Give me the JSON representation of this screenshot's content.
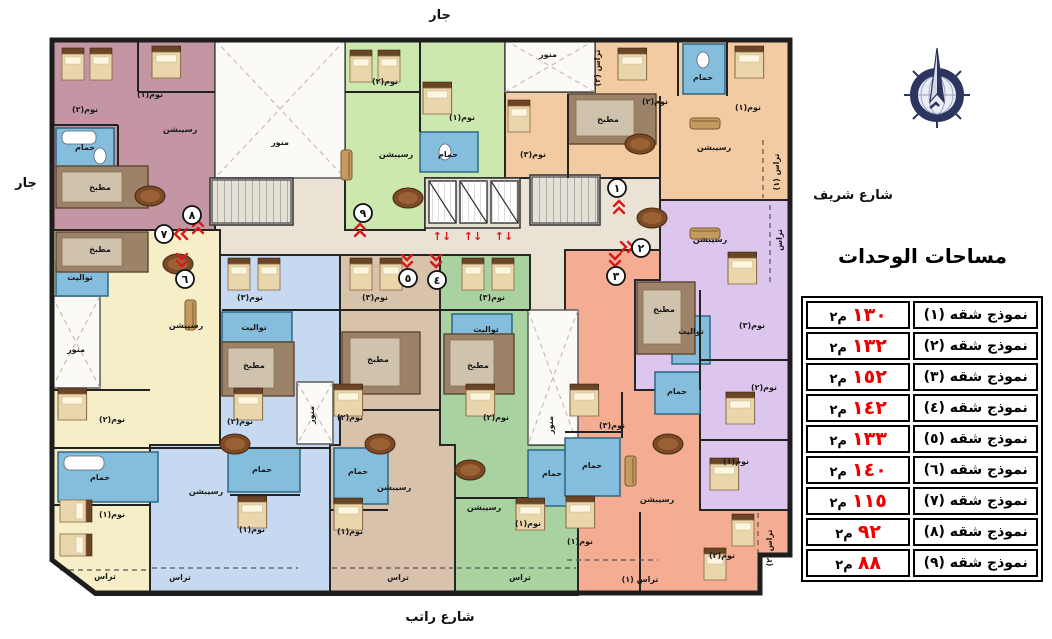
{
  "surroundings": {
    "top": "جار",
    "left": "جار",
    "right": "شارع شريف",
    "bottom": "شارع راتب"
  },
  "legend": {
    "title": "مساحات الوحدات",
    "unit_suffix": "م٢",
    "area_color": "#ee0000",
    "rows": [
      {
        "model": "نموذج شقه (١)",
        "area": "١٣٠"
      },
      {
        "model": "نموذج شقه (٢)",
        "area": "١٣٢"
      },
      {
        "model": "نموذج شقه (٣)",
        "area": "١٥٢"
      },
      {
        "model": "نموذج شقه (٤)",
        "area": "١٤٢"
      },
      {
        "model": "نموذج شقه (٥)",
        "area": "١٣٣"
      },
      {
        "model": "نموذج شقه (٦)",
        "area": "١٤٠"
      },
      {
        "model": "نموذج شقه (٧)",
        "area": "١١٥"
      },
      {
        "model": "نموذج شقه (٨)",
        "area": "٩٢"
      },
      {
        "model": "نموذج شقه (٩)",
        "area": "٨٨"
      }
    ]
  },
  "compass": {
    "name": "compass-rose",
    "ring_color": "#2b3560",
    "face_color": "#e9edf5"
  },
  "plan": {
    "corridor_color": "#eae2d4",
    "wall_color": "#1d1d1d",
    "arrow_color": "#d81a1a",
    "units": [
      {
        "id": 1,
        "number": "١",
        "color": "#f2cba2"
      },
      {
        "id": 2,
        "number": "٢",
        "color": "#ddc6ee"
      },
      {
        "id": 3,
        "number": "٣",
        "color": "#f4ad92"
      },
      {
        "id": 4,
        "number": "٤",
        "color": "#a9d2a0"
      },
      {
        "id": 5,
        "number": "٥",
        "color": "#d9c2ac"
      },
      {
        "id": 6,
        "number": "٦",
        "color": "#c6d9f1"
      },
      {
        "id": 7,
        "number": "٧",
        "color": "#f5eec6"
      },
      {
        "id": 8,
        "number": "٨",
        "color": "#c495a3"
      },
      {
        "id": 9,
        "number": "٩",
        "color": "#cce8ae"
      }
    ],
    "room_labels": [
      {
        "t": "نوم(٢)",
        "x": 85,
        "y": 112
      },
      {
        "t": "نوم(١)",
        "x": 150,
        "y": 97
      },
      {
        "t": "رسيبشن",
        "x": 180,
        "y": 132
      },
      {
        "t": "حمام",
        "x": 85,
        "y": 150
      },
      {
        "t": "مطبخ",
        "x": 100,
        "y": 190
      },
      {
        "t": "منور",
        "x": 280,
        "y": 145
      },
      {
        "t": "نوم(٢)",
        "x": 385,
        "y": 84
      },
      {
        "t": "نوم(١)",
        "x": 462,
        "y": 120
      },
      {
        "t": "حمام",
        "x": 448,
        "y": 157
      },
      {
        "t": "رسيبشن",
        "x": 396,
        "y": 157
      },
      {
        "t": "منور",
        "x": 548,
        "y": 57
      },
      {
        "t": "تراس (٢)",
        "x": 600,
        "y": 68,
        "r": -90
      },
      {
        "t": "نوم(٢)",
        "x": 655,
        "y": 104
      },
      {
        "t": "حمام",
        "x": 703,
        "y": 80
      },
      {
        "t": "نوم(١)",
        "x": 748,
        "y": 110
      },
      {
        "t": "نوم(٣)",
        "x": 533,
        "y": 157
      },
      {
        "t": "مطبخ",
        "x": 608,
        "y": 122
      },
      {
        "t": "رسيبشن",
        "x": 714,
        "y": 150
      },
      {
        "t": "تراس (١)",
        "x": 779,
        "y": 172,
        "r": -90
      },
      {
        "t": "رسيبشن",
        "x": 710,
        "y": 242
      },
      {
        "t": "تراس",
        "x": 782,
        "y": 240,
        "r": -90
      },
      {
        "t": "مطبخ",
        "x": 664,
        "y": 312
      },
      {
        "t": "تواليت",
        "x": 691,
        "y": 334
      },
      {
        "t": "نوم(٣)",
        "x": 752,
        "y": 328
      },
      {
        "t": "نوم(٢)",
        "x": 764,
        "y": 390
      },
      {
        "t": "نوم(١)",
        "x": 736,
        "y": 464
      },
      {
        "t": "حمام",
        "x": 677,
        "y": 394
      },
      {
        "t": "نوم(٣)",
        "x": 612,
        "y": 428
      },
      {
        "t": "حمام",
        "x": 592,
        "y": 468
      },
      {
        "t": "رسيبشن",
        "x": 657,
        "y": 502
      },
      {
        "t": "نوم(١)",
        "x": 580,
        "y": 544
      },
      {
        "t": "نوم(٢)",
        "x": 722,
        "y": 558
      },
      {
        "t": "تراس (١)",
        "x": 640,
        "y": 582
      },
      {
        "t": "تراس (٢)",
        "x": 772,
        "y": 548,
        "r": -90
      },
      {
        "t": "مطبخ",
        "x": 100,
        "y": 252
      },
      {
        "t": "تواليت",
        "x": 80,
        "y": 280
      },
      {
        "t": "رسيبشن",
        "x": 186,
        "y": 328
      },
      {
        "t": "منور",
        "x": 76,
        "y": 352
      },
      {
        "t": "نوم(٢)",
        "x": 112,
        "y": 422
      },
      {
        "t": "حمام",
        "x": 100,
        "y": 480
      },
      {
        "t": "نوم(١)",
        "x": 112,
        "y": 517
      },
      {
        "t": "تراس",
        "x": 105,
        "y": 579
      },
      {
        "t": "نوم(٣)",
        "x": 250,
        "y": 300
      },
      {
        "t": "تواليت",
        "x": 254,
        "y": 330
      },
      {
        "t": "مطبخ",
        "x": 254,
        "y": 368
      },
      {
        "t": "نوم(٢)",
        "x": 240,
        "y": 424
      },
      {
        "t": "حمام",
        "x": 262,
        "y": 472
      },
      {
        "t": "رسيبشن",
        "x": 206,
        "y": 494
      },
      {
        "t": "نوم(١)",
        "x": 252,
        "y": 532
      },
      {
        "t": "تراس",
        "x": 180,
        "y": 580
      },
      {
        "t": "نوم(٣)",
        "x": 375,
        "y": 300
      },
      {
        "t": "مطبخ",
        "x": 378,
        "y": 362
      },
      {
        "t": "نوم(٢)",
        "x": 350,
        "y": 420
      },
      {
        "t": "حمام",
        "x": 358,
        "y": 474
      },
      {
        "t": "رسيبشن",
        "x": 394,
        "y": 490
      },
      {
        "t": "نوم(١)",
        "x": 350,
        "y": 534
      },
      {
        "t": "تراس",
        "x": 398,
        "y": 580
      },
      {
        "t": "نوم(٣)",
        "x": 492,
        "y": 300
      },
      {
        "t": "تواليت",
        "x": 486,
        "y": 332
      },
      {
        "t": "مطبخ",
        "x": 478,
        "y": 368
      },
      {
        "t": "نوم(٢)",
        "x": 496,
        "y": 420
      },
      {
        "t": "حمام",
        "x": 552,
        "y": 476
      },
      {
        "t": "رسيبشن",
        "x": 484,
        "y": 510
      },
      {
        "t": "نوم(١)",
        "x": 528,
        "y": 526
      },
      {
        "t": "تراس",
        "x": 520,
        "y": 580
      },
      {
        "t": "منور",
        "x": 553,
        "y": 425,
        "r": -90
      },
      {
        "t": "منور",
        "x": 314,
        "y": 415,
        "r": -90
      }
    ],
    "unit_markers": [
      {
        "n": "١",
        "x": 617,
        "y": 188
      },
      {
        "n": "٢",
        "x": 641,
        "y": 248
      },
      {
        "n": "٣",
        "x": 616,
        "y": 276
      },
      {
        "n": "٤",
        "x": 437,
        "y": 280
      },
      {
        "n": "٥",
        "x": 408,
        "y": 278
      },
      {
        "n": "٦",
        "x": 185,
        "y": 279
      },
      {
        "n": "٧",
        "x": 164,
        "y": 234
      },
      {
        "n": "٨",
        "x": 192,
        "y": 215
      },
      {
        "n": "٩",
        "x": 363,
        "y": 213
      }
    ],
    "chevrons": [
      {
        "x": 360,
        "y": 229,
        "r": 180
      },
      {
        "x": 182,
        "y": 261,
        "r": 0
      },
      {
        "x": 180,
        "y": 234,
        "r": 90
      },
      {
        "x": 198,
        "y": 226,
        "r": 180
      },
      {
        "x": 407,
        "y": 262,
        "r": 0
      },
      {
        "x": 436,
        "y": 262,
        "r": 0
      },
      {
        "x": 615,
        "y": 261,
        "r": 0
      },
      {
        "x": 628,
        "y": 247,
        "r": -90
      },
      {
        "x": 619,
        "y": 206,
        "r": 180
      }
    ],
    "lift_arrows": [
      {
        "x": 442,
        "y": 240
      },
      {
        "x": 473,
        "y": 240
      },
      {
        "x": 504,
        "y": 240
      }
    ],
    "furniture": [
      {
        "k": "bed",
        "x": 62,
        "y": 48
      },
      {
        "k": "bed",
        "x": 90,
        "y": 48
      },
      {
        "k": "bed",
        "x": 152,
        "y": 46,
        "s": 1.3
      },
      {
        "k": "bed",
        "x": 350,
        "y": 50
      },
      {
        "k": "bed",
        "x": 378,
        "y": 50
      },
      {
        "k": "bed",
        "x": 423,
        "y": 82,
        "s": 1.3
      },
      {
        "k": "bed",
        "x": 618,
        "y": 48,
        "s": 1.3
      },
      {
        "k": "bed",
        "x": 735,
        "y": 46,
        "s": 1.3
      },
      {
        "k": "bed",
        "x": 508,
        "y": 100
      },
      {
        "k": "bed",
        "x": 728,
        "y": 252,
        "s": 1.3
      },
      {
        "k": "bed",
        "x": 726,
        "y": 392,
        "s": 1.3
      },
      {
        "k": "bed",
        "x": 710,
        "y": 458,
        "s": 1.3
      },
      {
        "k": "bed",
        "x": 58,
        "y": 388,
        "s": 1.3
      },
      {
        "k": "bed",
        "x": 92,
        "y": 500,
        "r": 90
      },
      {
        "k": "bed",
        "x": 92,
        "y": 534,
        "r": 90
      },
      {
        "k": "bed",
        "x": 228,
        "y": 258
      },
      {
        "k": "bed",
        "x": 258,
        "y": 258
      },
      {
        "k": "bed",
        "x": 234,
        "y": 388,
        "s": 1.3
      },
      {
        "k": "bed",
        "x": 238,
        "y": 496,
        "s": 1.3
      },
      {
        "k": "bed",
        "x": 350,
        "y": 258
      },
      {
        "k": "bed",
        "x": 380,
        "y": 258
      },
      {
        "k": "bed",
        "x": 334,
        "y": 384,
        "s": 1.3
      },
      {
        "k": "bed",
        "x": 334,
        "y": 498,
        "s": 1.3
      },
      {
        "k": "bed",
        "x": 462,
        "y": 258
      },
      {
        "k": "bed",
        "x": 492,
        "y": 258
      },
      {
        "k": "bed",
        "x": 466,
        "y": 384,
        "s": 1.3
      },
      {
        "k": "bed",
        "x": 516,
        "y": 498,
        "s": 1.3
      },
      {
        "k": "bed",
        "x": 570,
        "y": 384,
        "s": 1.3
      },
      {
        "k": "bed",
        "x": 566,
        "y": 496,
        "s": 1.3
      },
      {
        "k": "bed",
        "x": 732,
        "y": 514
      },
      {
        "k": "bed",
        "x": 704,
        "y": 548
      },
      {
        "k": "tbl",
        "x": 150,
        "y": 196
      },
      {
        "k": "tbl",
        "x": 408,
        "y": 198
      },
      {
        "k": "tbl",
        "x": 178,
        "y": 264
      },
      {
        "k": "tbl",
        "x": 235,
        "y": 444
      },
      {
        "k": "tbl",
        "x": 380,
        "y": 444
      },
      {
        "k": "tbl",
        "x": 470,
        "y": 470
      },
      {
        "k": "tbl",
        "x": 668,
        "y": 444
      },
      {
        "k": "tbl",
        "x": 652,
        "y": 218
      },
      {
        "k": "tbl",
        "x": 640,
        "y": 144
      },
      {
        "k": "sofa",
        "x": 352,
        "y": 150,
        "r": 90
      },
      {
        "k": "sofa",
        "x": 690,
        "y": 118
      },
      {
        "k": "sofa",
        "x": 690,
        "y": 228
      },
      {
        "k": "sofa",
        "x": 636,
        "y": 456,
        "r": 90
      },
      {
        "k": "sofa",
        "x": 196,
        "y": 300,
        "r": 90
      }
    ]
  }
}
